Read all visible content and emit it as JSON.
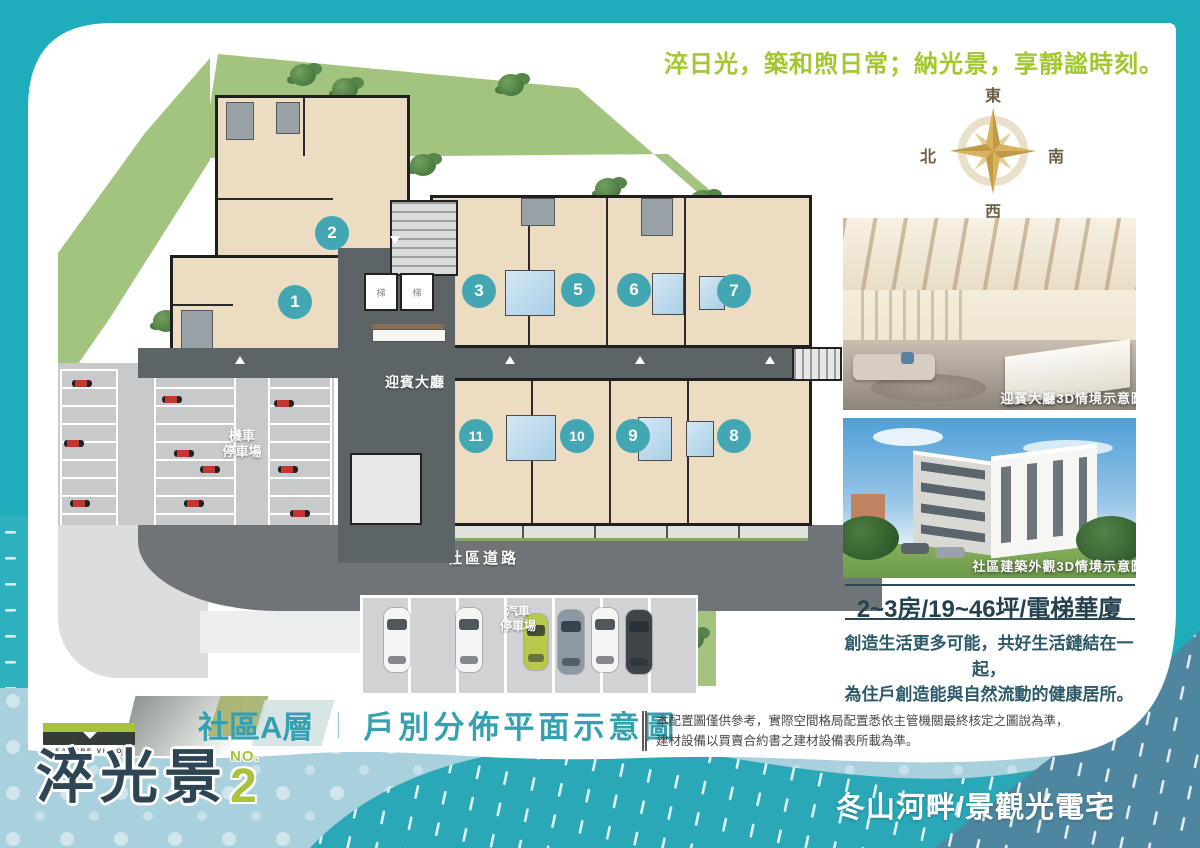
{
  "tagline": "淬日光，築和煦日常；納光景，享靜謐時刻。",
  "compass": {
    "east": "東",
    "south": "南",
    "west": "西",
    "north": "北"
  },
  "floor_plan": {
    "lobby_label": "迎賓大廳",
    "moto_parking_line1": "機車",
    "moto_parking_line2": "停車場",
    "car_parking_line1": "汽車",
    "car_parking_line2": "停車場",
    "road_label": "社區道路",
    "elevator_label": "梯",
    "units": [
      {
        "no": "1"
      },
      {
        "no": "2"
      },
      {
        "no": "3"
      },
      {
        "no": "5"
      },
      {
        "no": "6"
      },
      {
        "no": "7"
      },
      {
        "no": "8"
      },
      {
        "no": "9"
      },
      {
        "no": "10"
      },
      {
        "no": "11"
      }
    ]
  },
  "sidebar": {
    "image1_caption": "迎賓大廳3D情境示意圖",
    "image2_caption": "社區建築外觀3D情境示意圖",
    "spec": "2~3房/19~46坪/電梯華廈",
    "desc_line1": "創造生活更多可能，共好生活鏈結在一起，",
    "desc_line2": "為住戶創造能與自然流動的健康居所。"
  },
  "footer": {
    "plan_title_left": "社區A層",
    "plan_title_divider": "｜",
    "plan_title_right": "戶別分佈平面示意圖",
    "disclaimer_line1": "本配置圖僅供參考，實際空間格局配置悉依主管機關最終核定之圖說為準，",
    "disclaimer_line2": "建材設備以買賣合約書之建材設備表所載為準。",
    "brand": {
      "logo_text": "TREASURE VISION",
      "name": "淬光景",
      "no_label": "NO.",
      "number": "2"
    },
    "slogan": "冬山河畔/景觀光電宅"
  },
  "colors": {
    "teal_border": "#1fadbc",
    "accent_green": "#a2c731",
    "unit_badge": "#43a7b3",
    "headline_dark": "#24424f",
    "wave_teal": "#2ba8b8",
    "steel_blue": "#4e86a0",
    "compass_gold": "#d9b25f",
    "title_teal": "#35a0b2"
  }
}
